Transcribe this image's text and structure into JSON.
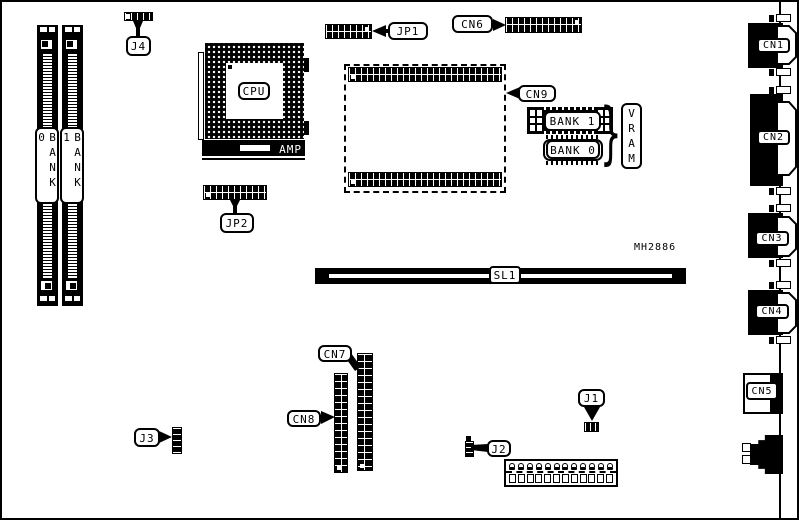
{
  "board": {
    "part_number": "MH2886",
    "cpu_label": "CPU",
    "amp_label": "AMP",
    "slot_sl1": "SL1",
    "vram_label": "VRAM",
    "vram_brace": "}",
    "vram_bank0": "BANK 0",
    "vram_bank1": "BANK 1",
    "simm_bank0": "BANK 0",
    "simm_bank1": "BANK 1",
    "connectors": {
      "cn1": "CN1",
      "cn2": "CN2",
      "cn3": "CN3",
      "cn4": "CN4",
      "cn5": "CN5",
      "cn6": "CN6",
      "cn7": "CN7",
      "cn8": "CN8",
      "cn9": "CN9"
    },
    "jumpers": {
      "j1": "J1",
      "j2": "J2",
      "j3": "J3",
      "j4": "J4",
      "jp1": "JP1",
      "jp2": "JP2"
    },
    "colors": {
      "ink": "#000000",
      "paper": "#ffffff"
    }
  }
}
